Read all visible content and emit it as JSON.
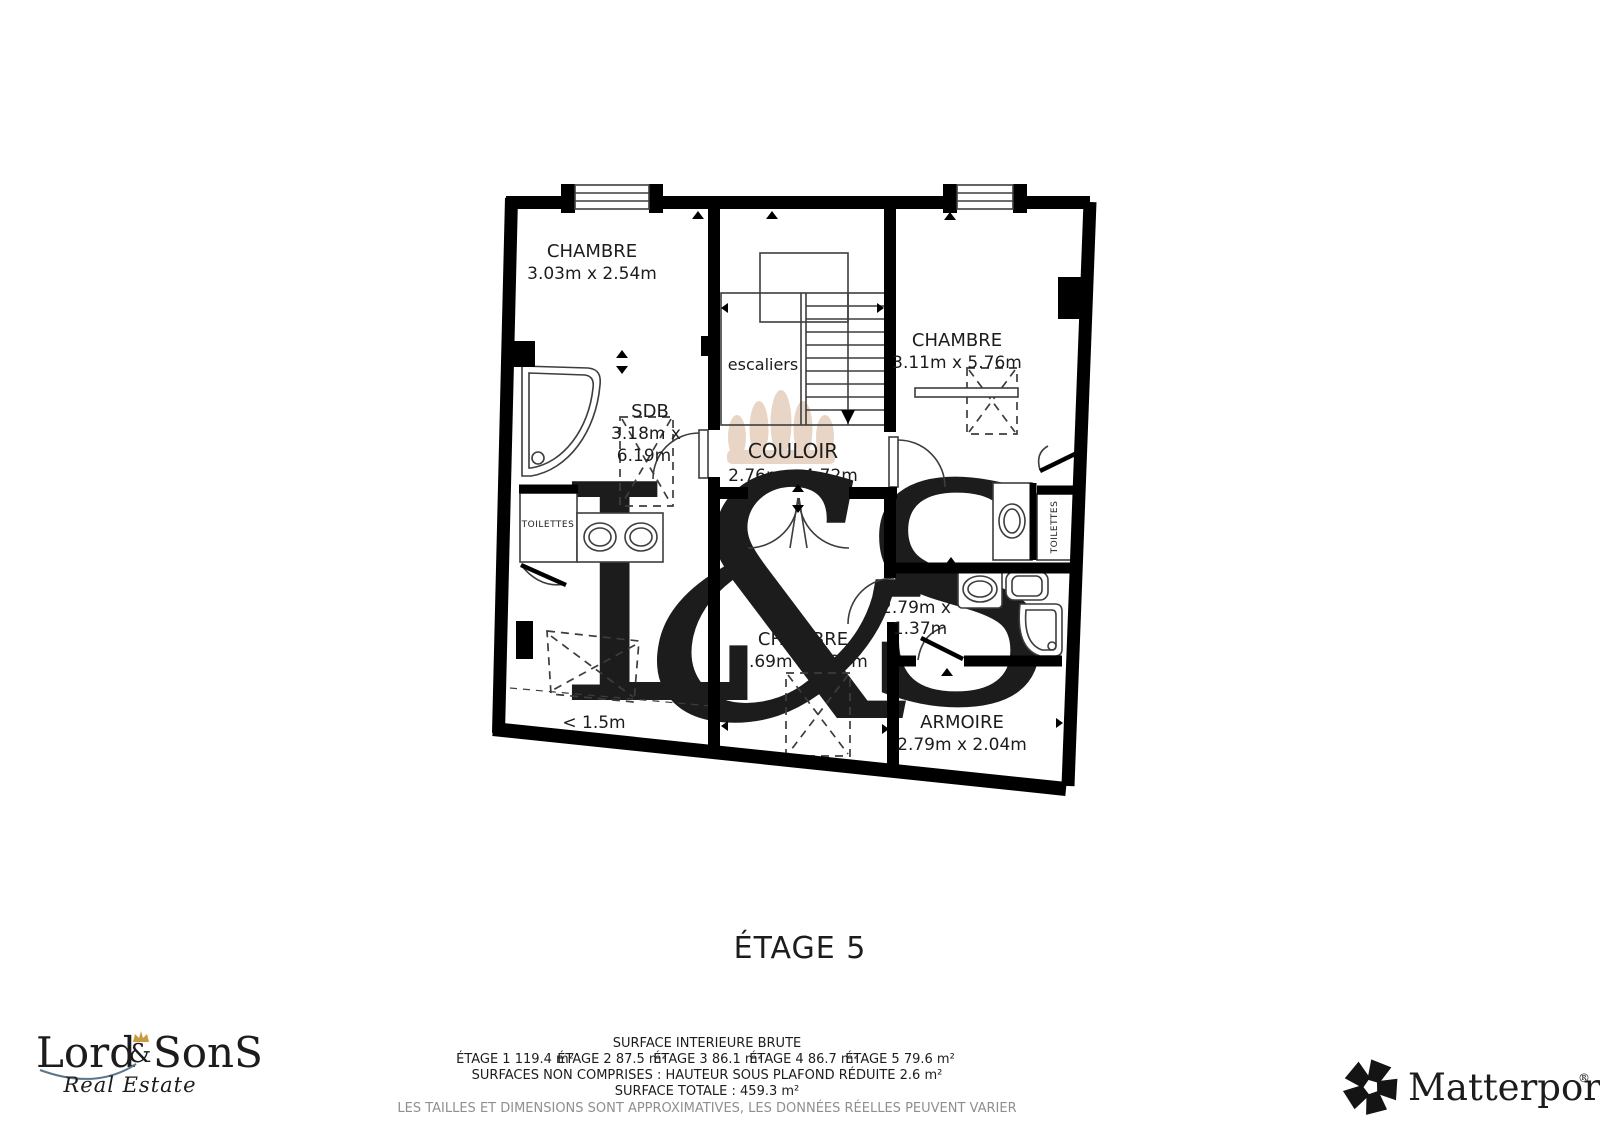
{
  "watermark": {
    "l": "L",
    "amp": "&",
    "s": "S"
  },
  "plan": {
    "title": "ÉTAGE 5",
    "rooms": {
      "chambre_tl": {
        "name": "CHAMBRE",
        "dims": "3.03m x 2.54m"
      },
      "chambre_r": {
        "name": "CHAMBRE",
        "dims": "3.11m x 5.76m"
      },
      "sdb_l": {
        "name": "SDB",
        "dims1": "3.18m x",
        "dims2": "6.19m"
      },
      "couloir": {
        "name": "COULOIR",
        "dims": "2.76m x 4.72m"
      },
      "escaliers": {
        "name": "escaliers"
      },
      "toilettes_l": {
        "name": "TOILETTES"
      },
      "toilettes_r": {
        "name": "TOILETTES"
      },
      "sdb_r": {
        "name": "SDB",
        "dims1": "2.79m x",
        "dims2": "1.37m"
      },
      "chambre_b": {
        "name": "CHAMBRE",
        "dims": "2.69m x 4.29m"
      },
      "armoire": {
        "name": "ARMOIRE",
        "dims": "2.79m x 2.04m"
      },
      "reduced": {
        "label": "< 1.5m"
      }
    }
  },
  "footer": {
    "line1": "SURFACE INTERIEURE BRUTE",
    "etages": [
      "ÉTAGE 1 119.4 m²",
      "ÉTAGE 2 87.5 m²",
      "ÉTAGE 3 86.1 m²",
      "ÉTAGE 4 86.7 m²",
      "ÉTAGE 5 79.6 m²"
    ],
    "line3": "SURFACES NON COMPRISES :  HAUTEUR SOUS PLAFOND RÉDUITE 2.6 m²",
    "line4": "SURFACE TOTALE :  459.3 m²",
    "disclaimer": "LES TAILLES ET DIMENSIONS SONT APPROXIMATIVES, LES DONNÉES RÉELLES PEUVENT VARIER"
  },
  "logos": {
    "lordsons": {
      "part1": "Lord",
      "amp": "&",
      "part2": "SonS",
      "tagline": "Real Estate"
    },
    "matterport": {
      "name": "Matterport",
      "reg": "®"
    }
  },
  "colors": {
    "wall": "#000000",
    "line": "#3d3d3d",
    "label": "#1c1c1c",
    "muted": "#8f8f8f",
    "watermark_crown": "#e9d5c5",
    "watermark_letters": "#f4f0e2",
    "logo_blue": "#5d7589",
    "logo_gold": "#c99a3f",
    "matterport_black": "#141414"
  }
}
